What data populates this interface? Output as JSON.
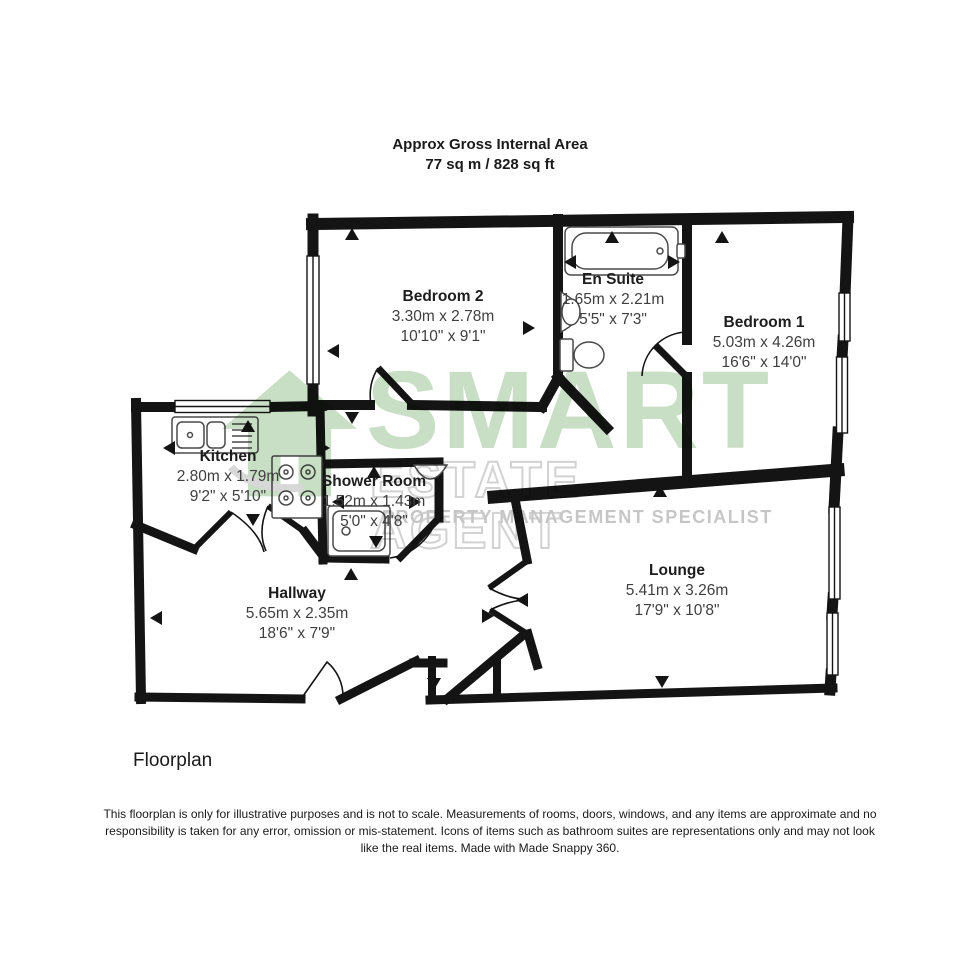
{
  "header": {
    "title": "Approx Gross Internal Area",
    "area": "77 sq m / 828 sq ft"
  },
  "rooms": {
    "bedroom2": {
      "name": "Bedroom 2",
      "metric": "3.30m x 2.78m",
      "imperial": "10'10\" x 9'1\""
    },
    "ensuite": {
      "name": "En Suite",
      "metric": "1.65m x 2.21m",
      "imperial": "5'5\" x 7'3\""
    },
    "bedroom1": {
      "name": "Bedroom 1",
      "metric": "5.03m x 4.26m",
      "imperial": "16'6\" x 14'0\""
    },
    "kitchen": {
      "name": "Kitchen",
      "metric": "2.80m x 1.79m",
      "imperial": "9'2\" x 5'10\""
    },
    "shower": {
      "name": "Shower Room",
      "metric": "1.52m x 1.43m",
      "imperial": "5'0\" x 4'8\""
    },
    "hallway": {
      "name": "Hallway",
      "metric": "5.65m x 2.35m",
      "imperial": "18'6\" x 7'9\""
    },
    "lounge": {
      "name": "Lounge",
      "metric": "5.41m x 3.26m",
      "imperial": "17'9\" x 10'8\""
    }
  },
  "watermark": {
    "brand": "SMART",
    "line2": "ESTATE AGENT",
    "line3": "PROPERTY MANAGEMENT SPECIALIST",
    "brand_color": "#c9dfc5",
    "outline_color": "#d2d2d2",
    "tagline_color": "#c6c6c6"
  },
  "footer": {
    "label": "Floorplan",
    "disclaimer": "This floorplan is only for illustrative purposes and is not to scale. Measurements of rooms, doors, windows, and any items are approximate and no responsibility is taken for any error, omission or mis-statement. Icons of items such as bathroom suites are representations only and may not look like the real items. Made with Made Snappy 360."
  },
  "colors": {
    "wall": "#141414",
    "background": "#ffffff"
  }
}
